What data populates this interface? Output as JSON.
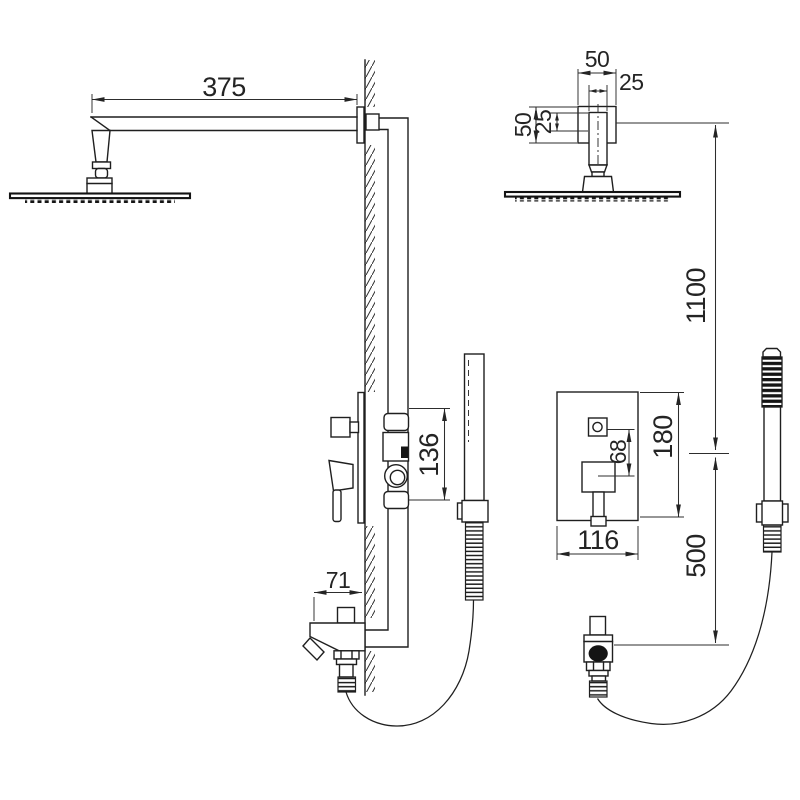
{
  "diagram": {
    "dims": {
      "arm_length": "375",
      "flange_width": "50",
      "pipe_width": "25",
      "flange_height": "50",
      "pipe_offset": "25",
      "upper_height": "1100",
      "valve_height": "136",
      "plate_height": "180",
      "button_to_handle": "68",
      "plate_width": "116",
      "spout_depth": "71",
      "lower_height": "500"
    }
  }
}
